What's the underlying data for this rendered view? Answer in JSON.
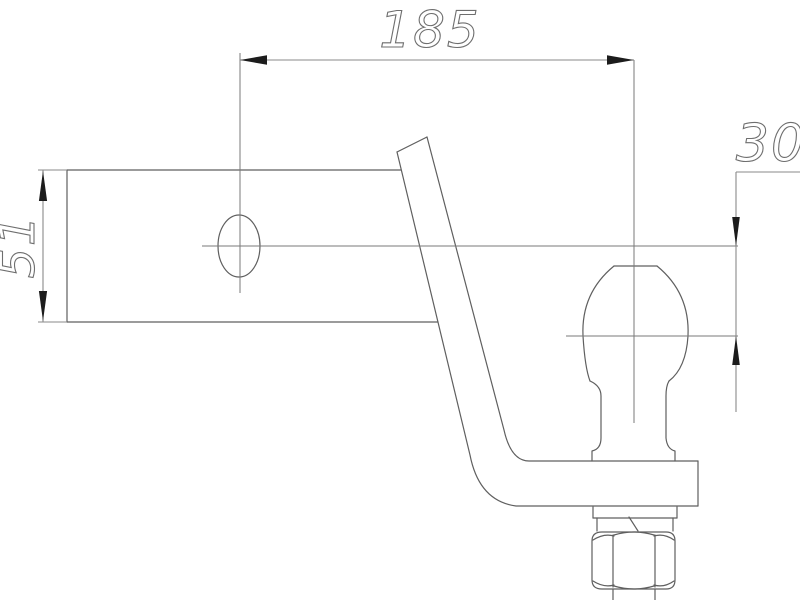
{
  "drawing": {
    "dimensions": {
      "hole_to_ball_length": "185",
      "ball_drop": "30",
      "shank_height": "51"
    },
    "colors": {
      "background": "#ffffff",
      "outline": "#5f5f5f",
      "centerline": "#7a7a7a",
      "dimension": "#8a8a8a",
      "arrow": "#1c1c1c",
      "text_stroke": "#6e6e6e"
    }
  }
}
